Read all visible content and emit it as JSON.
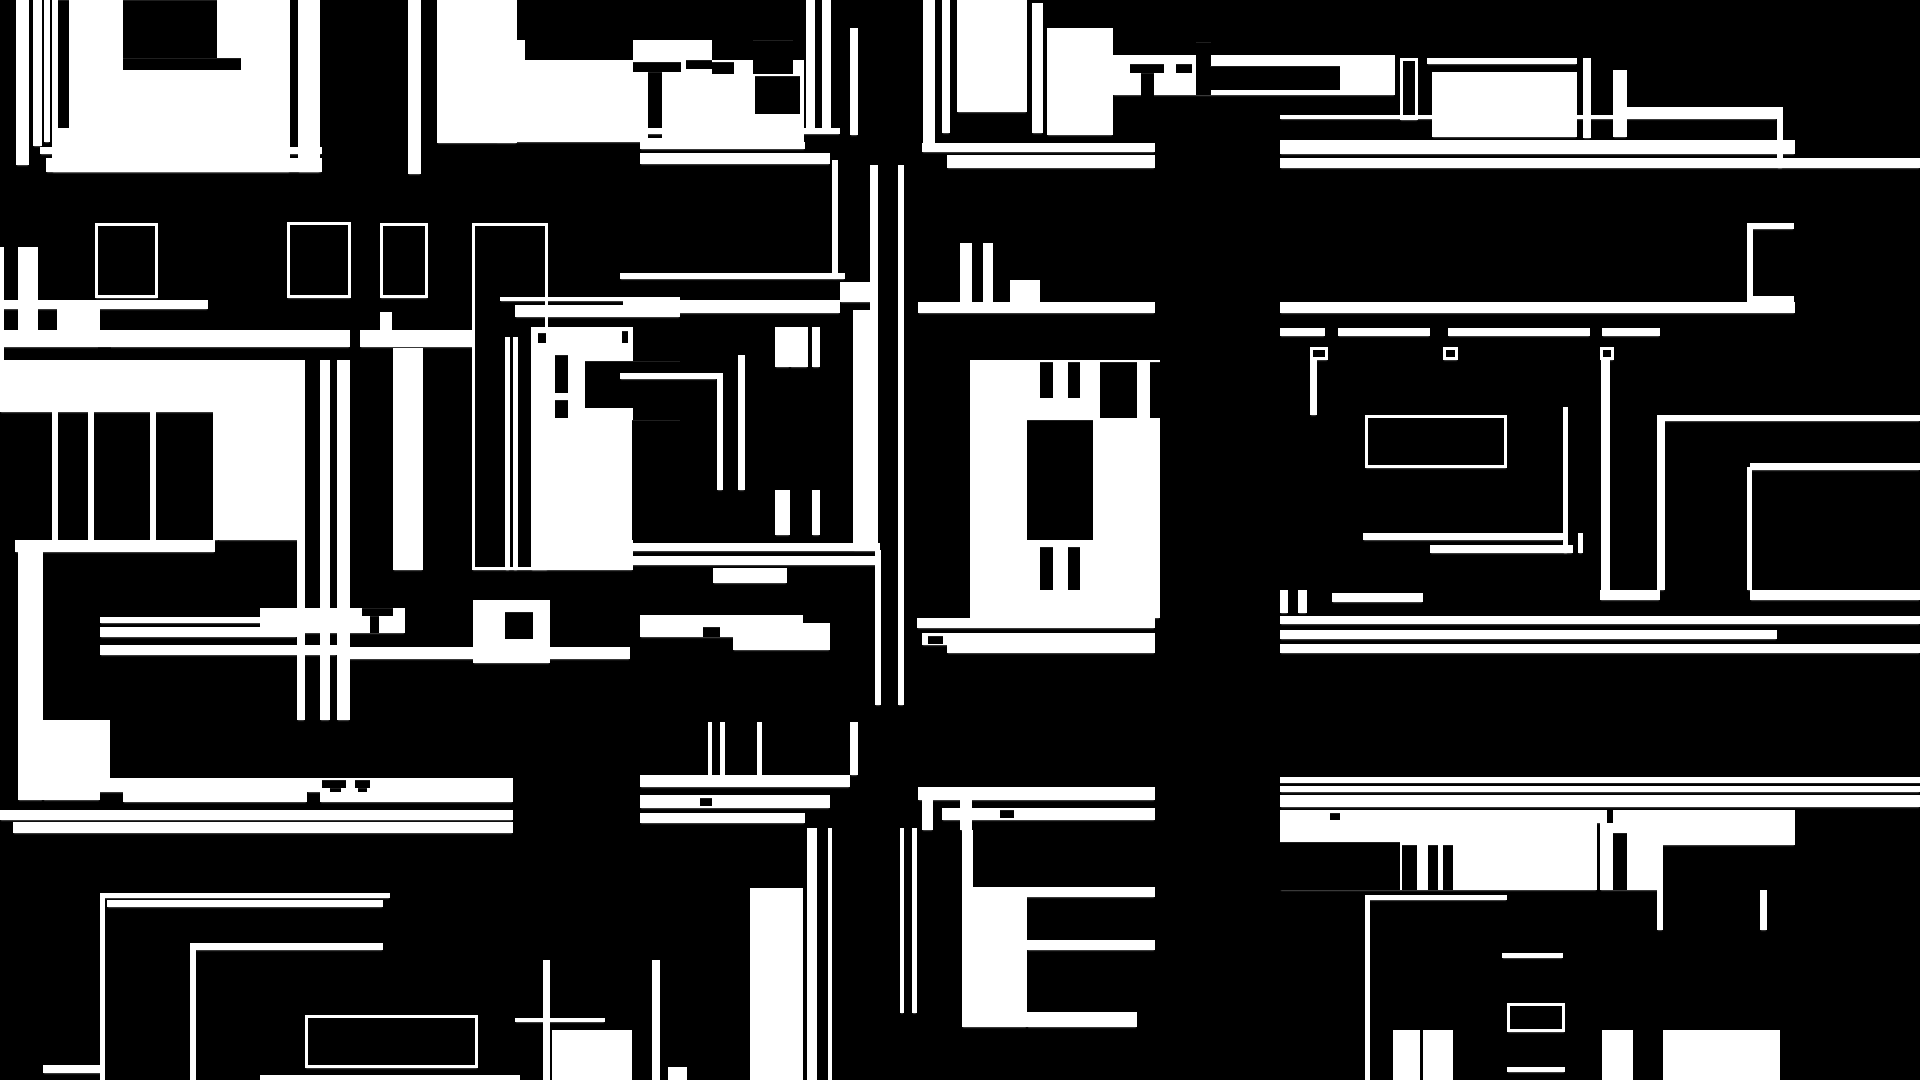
{
  "canvas": {
    "width": 1920,
    "height": 1080,
    "background_color": "#000000",
    "shape_color": "#ffffff",
    "edge_antialias_tint": "#999999",
    "kind_legend": {
      "f": "white-filled-block",
      "b": "black-cutout-block",
      "o": "white-outlined-frame"
    },
    "content_type": "abstract-glitch-mosaic",
    "visible_text": ""
  },
  "rects": [
    [
      16,
      0,
      13,
      165,
      "f"
    ],
    [
      33,
      0,
      9,
      146,
      "f"
    ],
    [
      44,
      0,
      6,
      142,
      "f"
    ],
    [
      52,
      0,
      238,
      172,
      "f"
    ],
    [
      298,
      0,
      22,
      172,
      "f"
    ],
    [
      58,
      0,
      11,
      128,
      "b"
    ],
    [
      123,
      0,
      94,
      58,
      "b"
    ],
    [
      123,
      58,
      118,
      12,
      "b"
    ],
    [
      40,
      147,
      282,
      7,
      "f"
    ],
    [
      46,
      158,
      276,
      14,
      "f"
    ],
    [
      408,
      0,
      13,
      174,
      "f"
    ],
    [
      437,
      0,
      80,
      143,
      "f"
    ],
    [
      500,
      38,
      9,
      102,
      "f"
    ],
    [
      517,
      40,
      8,
      98,
      "f"
    ],
    [
      633,
      40,
      79,
      22,
      "f"
    ],
    [
      496,
      60,
      308,
      82,
      "f"
    ],
    [
      633,
      62,
      48,
      10,
      "b"
    ],
    [
      648,
      72,
      14,
      66,
      "b"
    ],
    [
      686,
      60,
      26,
      9,
      "b"
    ],
    [
      712,
      62,
      22,
      12,
      "b"
    ],
    [
      753,
      40,
      40,
      34,
      "b"
    ],
    [
      755,
      76,
      45,
      38,
      "b"
    ],
    [
      806,
      0,
      9,
      132,
      "f"
    ],
    [
      822,
      0,
      9,
      132,
      "f"
    ],
    [
      850,
      28,
      8,
      107,
      "f"
    ],
    [
      923,
      0,
      12,
      143,
      "f"
    ],
    [
      942,
      0,
      8,
      133,
      "f"
    ],
    [
      957,
      0,
      70,
      112,
      "f"
    ],
    [
      1032,
      3,
      11,
      130,
      "f"
    ],
    [
      1047,
      28,
      66,
      107,
      "f"
    ],
    [
      1113,
      55,
      282,
      40,
      "f"
    ],
    [
      1130,
      64,
      34,
      9,
      "b"
    ],
    [
      1141,
      73,
      13,
      54,
      "b"
    ],
    [
      1176,
      64,
      16,
      9,
      "b"
    ],
    [
      1196,
      42,
      15,
      53,
      "b"
    ],
    [
      1210,
      66,
      130,
      24,
      "b"
    ],
    [
      1400,
      58,
      18,
      62,
      "o"
    ],
    [
      1427,
      58,
      150,
      6,
      "f"
    ],
    [
      1432,
      72,
      145,
      65,
      "f"
    ],
    [
      1583,
      58,
      8,
      80,
      "f"
    ],
    [
      1613,
      70,
      14,
      67,
      "f"
    ],
    [
      1627,
      107,
      150,
      9,
      "f"
    ],
    [
      1280,
      115,
      497,
      4,
      "f"
    ],
    [
      1777,
      107,
      6,
      61,
      "f"
    ],
    [
      622,
      128,
      218,
      6,
      "f"
    ],
    [
      640,
      142,
      165,
      7,
      "f"
    ],
    [
      640,
      153,
      190,
      11,
      "f"
    ],
    [
      922,
      143,
      233,
      9,
      "f"
    ],
    [
      947,
      155,
      208,
      13,
      "f"
    ],
    [
      1280,
      140,
      515,
      14,
      "f"
    ],
    [
      1280,
      158,
      640,
      10,
      "f"
    ],
    [
      832,
      160,
      6,
      118,
      "f"
    ],
    [
      853,
      310,
      25,
      240,
      "f"
    ],
    [
      870,
      165,
      8,
      148,
      "f"
    ],
    [
      898,
      165,
      6,
      540,
      "f"
    ],
    [
      875,
      550,
      6,
      155,
      "f"
    ],
    [
      620,
      273,
      225,
      6,
      "f"
    ],
    [
      840,
      282,
      38,
      20,
      "f"
    ],
    [
      623,
      300,
      217,
      13,
      "f"
    ],
    [
      0,
      300,
      208,
      9,
      "f"
    ],
    [
      918,
      302,
      237,
      11,
      "f"
    ],
    [
      1280,
      302,
      515,
      11,
      "f"
    ],
    [
      0,
      330,
      350,
      17,
      "f"
    ],
    [
      360,
      330,
      162,
      17,
      "f"
    ],
    [
      98,
      347,
      13,
      14,
      "b"
    ],
    [
      18,
      247,
      20,
      83,
      "f"
    ],
    [
      0,
      247,
      4,
      113,
      "f"
    ],
    [
      57,
      309,
      43,
      21,
      "f"
    ],
    [
      960,
      243,
      12,
      60,
      "f"
    ],
    [
      983,
      243,
      10,
      60,
      "f"
    ],
    [
      1010,
      280,
      30,
      22,
      "f"
    ],
    [
      1280,
      328,
      45,
      8,
      "f"
    ],
    [
      1338,
      328,
      92,
      8,
      "f"
    ],
    [
      1448,
      328,
      142,
      8,
      "f"
    ],
    [
      1602,
      328,
      58,
      8,
      "f"
    ],
    [
      1310,
      347,
      18,
      13,
      "o"
    ],
    [
      1443,
      347,
      15,
      13,
      "o"
    ],
    [
      1600,
      347,
      14,
      13,
      "o"
    ],
    [
      95,
      223,
      63,
      75,
      "o"
    ],
    [
      287,
      222,
      64,
      76,
      "o"
    ],
    [
      380,
      223,
      48,
      75,
      "o"
    ],
    [
      1747,
      223,
      47,
      6,
      "f"
    ],
    [
      1747,
      229,
      6,
      67,
      "f"
    ],
    [
      1747,
      296,
      47,
      6,
      "f"
    ],
    [
      472,
      223,
      76,
      347,
      "o"
    ],
    [
      505,
      337,
      5,
      233,
      "f"
    ],
    [
      513,
      337,
      5,
      233,
      "f"
    ],
    [
      380,
      312,
      12,
      31,
      "f"
    ],
    [
      393,
      348,
      30,
      222,
      "f"
    ],
    [
      500,
      297,
      180,
      4,
      "f"
    ],
    [
      515,
      305,
      165,
      12,
      "f"
    ],
    [
      531,
      327,
      102,
      243,
      "f"
    ],
    [
      538,
      333,
      8,
      10,
      "b"
    ],
    [
      622,
      331,
      6,
      12,
      "b"
    ],
    [
      555,
      355,
      13,
      38,
      "b"
    ],
    [
      555,
      400,
      13,
      18,
      "b"
    ],
    [
      585,
      361,
      95,
      47,
      "b"
    ],
    [
      632,
      420,
      48,
      120,
      "b"
    ],
    [
      0,
      360,
      300,
      52,
      "f"
    ],
    [
      52,
      412,
      6,
      128,
      "f"
    ],
    [
      88,
      412,
      6,
      128,
      "f"
    ],
    [
      150,
      412,
      6,
      128,
      "f"
    ],
    [
      213,
      412,
      6,
      128,
      "f"
    ],
    [
      218,
      412,
      82,
      128,
      "f"
    ],
    [
      297,
      360,
      8,
      360,
      "f"
    ],
    [
      15,
      540,
      200,
      12,
      "f"
    ],
    [
      18,
      552,
      25,
      168,
      "f"
    ],
    [
      320,
      360,
      10,
      360,
      "f"
    ],
    [
      337,
      360,
      13,
      360,
      "f"
    ],
    [
      717,
      373,
      6,
      117,
      "f"
    ],
    [
      620,
      373,
      97,
      6,
      "f"
    ],
    [
      738,
      355,
      7,
      135,
      "f"
    ],
    [
      775,
      327,
      15,
      40,
      "f"
    ],
    [
      790,
      327,
      18,
      40,
      "f"
    ],
    [
      812,
      327,
      8,
      40,
      "f"
    ],
    [
      775,
      490,
      15,
      45,
      "f"
    ],
    [
      812,
      490,
      8,
      45,
      "f"
    ],
    [
      620,
      543,
      260,
      8,
      "f"
    ],
    [
      620,
      556,
      260,
      9,
      "f"
    ],
    [
      713,
      568,
      74,
      15,
      "f"
    ],
    [
      970,
      360,
      190,
      258,
      "f"
    ],
    [
      1027,
      420,
      66,
      120,
      "b"
    ],
    [
      1040,
      362,
      13,
      36,
      "b"
    ],
    [
      1068,
      362,
      12,
      36,
      "b"
    ],
    [
      1040,
      547,
      13,
      43,
      "b"
    ],
    [
      1068,
      547,
      12,
      43,
      "b"
    ],
    [
      1100,
      362,
      60,
      56,
      "b"
    ],
    [
      1137,
      360,
      13,
      150,
      "f"
    ],
    [
      1310,
      360,
      7,
      55,
      "f"
    ],
    [
      1365,
      415,
      142,
      53,
      "o"
    ],
    [
      1363,
      533,
      200,
      7,
      "f"
    ],
    [
      1430,
      545,
      143,
      8,
      "f"
    ],
    [
      1563,
      407,
      5,
      146,
      "f"
    ],
    [
      1578,
      533,
      5,
      20,
      "f"
    ],
    [
      1601,
      360,
      9,
      230,
      "f"
    ],
    [
      1657,
      415,
      8,
      175,
      "f"
    ],
    [
      1658,
      415,
      262,
      6,
      "f"
    ],
    [
      1747,
      467,
      5,
      123,
      "f"
    ],
    [
      1750,
      463,
      170,
      7,
      "f"
    ],
    [
      1600,
      590,
      60,
      10,
      "f"
    ],
    [
      1750,
      590,
      170,
      10,
      "f"
    ],
    [
      1332,
      593,
      91,
      9,
      "f"
    ],
    [
      1280,
      590,
      8,
      23,
      "f"
    ],
    [
      1298,
      590,
      9,
      23,
      "f"
    ],
    [
      100,
      617,
      183,
      6,
      "f"
    ],
    [
      100,
      627,
      197,
      10,
      "f"
    ],
    [
      100,
      645,
      237,
      10,
      "f"
    ],
    [
      260,
      608,
      145,
      25,
      "f"
    ],
    [
      362,
      608,
      31,
      8,
      "b"
    ],
    [
      370,
      616,
      9,
      17,
      "b"
    ],
    [
      340,
      647,
      290,
      12,
      "f"
    ],
    [
      473,
      600,
      77,
      63,
      "f"
    ],
    [
      505,
      612,
      28,
      27,
      "b"
    ],
    [
      640,
      615,
      163,
      8,
      "f"
    ],
    [
      640,
      623,
      190,
      14,
      "f"
    ],
    [
      703,
      627,
      17,
      10,
      "b"
    ],
    [
      733,
      637,
      97,
      13,
      "f"
    ],
    [
      917,
      618,
      238,
      10,
      "f"
    ],
    [
      922,
      633,
      233,
      12,
      "f"
    ],
    [
      928,
      636,
      15,
      8,
      "b"
    ],
    [
      947,
      645,
      208,
      8,
      "f"
    ],
    [
      1280,
      616,
      640,
      8,
      "f"
    ],
    [
      1280,
      630,
      497,
      9,
      "f"
    ],
    [
      1280,
      644,
      640,
      9,
      "f"
    ],
    [
      18,
      720,
      25,
      80,
      "f"
    ],
    [
      43,
      720,
      57,
      80,
      "f"
    ],
    [
      100,
      720,
      10,
      58,
      "f"
    ],
    [
      97,
      778,
      210,
      14,
      "f"
    ],
    [
      123,
      792,
      184,
      10,
      "f"
    ],
    [
      307,
      778,
      206,
      14,
      "f"
    ],
    [
      322,
      780,
      24,
      8,
      "b"
    ],
    [
      330,
      788,
      11,
      16,
      "b"
    ],
    [
      355,
      780,
      15,
      8,
      "b"
    ],
    [
      358,
      788,
      9,
      16,
      "b"
    ],
    [
      320,
      792,
      193,
      10,
      "f"
    ],
    [
      0,
      810,
      513,
      10,
      "f"
    ],
    [
      13,
      822,
      500,
      11,
      "f"
    ],
    [
      100,
      893,
      290,
      5,
      "f"
    ],
    [
      100,
      898,
      5,
      182,
      "f"
    ],
    [
      107,
      900,
      276,
      7,
      "f"
    ],
    [
      190,
      943,
      6,
      137,
      "f"
    ],
    [
      195,
      943,
      188,
      7,
      "f"
    ],
    [
      305,
      1015,
      173,
      53,
      "o"
    ],
    [
      515,
      1018,
      90,
      4,
      "f"
    ],
    [
      543,
      960,
      7,
      120,
      "f"
    ],
    [
      552,
      1030,
      80,
      50,
      "f"
    ],
    [
      652,
      960,
      8,
      120,
      "f"
    ],
    [
      43,
      1065,
      60,
      8,
      "f"
    ],
    [
      260,
      1075,
      260,
      5,
      "f"
    ],
    [
      640,
      775,
      210,
      12,
      "f"
    ],
    [
      640,
      795,
      190,
      13,
      "f"
    ],
    [
      700,
      798,
      12,
      8,
      "b"
    ],
    [
      640,
      813,
      165,
      10,
      "f"
    ],
    [
      708,
      722,
      4,
      53,
      "f"
    ],
    [
      720,
      722,
      5,
      53,
      "f"
    ],
    [
      757,
      722,
      5,
      53,
      "f"
    ],
    [
      850,
      722,
      8,
      53,
      "f"
    ],
    [
      750,
      888,
      53,
      192,
      "f"
    ],
    [
      807,
      828,
      10,
      252,
      "f"
    ],
    [
      828,
      828,
      4,
      252,
      "f"
    ],
    [
      900,
      828,
      4,
      185,
      "f"
    ],
    [
      912,
      828,
      5,
      185,
      "f"
    ],
    [
      918,
      787,
      237,
      13,
      "f"
    ],
    [
      942,
      808,
      213,
      12,
      "f"
    ],
    [
      1000,
      810,
      14,
      8,
      "b"
    ],
    [
      922,
      800,
      11,
      30,
      "f"
    ],
    [
      960,
      800,
      12,
      30,
      "f"
    ],
    [
      962,
      830,
      11,
      57,
      "f"
    ],
    [
      962,
      887,
      65,
      140,
      "f"
    ],
    [
      987,
      887,
      168,
      10,
      "f"
    ],
    [
      1027,
      940,
      128,
      10,
      "f"
    ],
    [
      1027,
      1012,
      110,
      15,
      "f"
    ],
    [
      668,
      1067,
      19,
      13,
      "f"
    ],
    [
      757,
      1067,
      23,
      13,
      "f"
    ],
    [
      1280,
      777,
      640,
      15,
      "f"
    ],
    [
      1280,
      783,
      640,
      3,
      "b"
    ],
    [
      1280,
      795,
      640,
      12,
      "f"
    ],
    [
      1280,
      810,
      327,
      13,
      "f"
    ],
    [
      1330,
      813,
      10,
      7,
      "b"
    ],
    [
      1613,
      810,
      182,
      13,
      "f"
    ],
    [
      1280,
      823,
      317,
      67,
      "f"
    ],
    [
      1280,
      842,
      120,
      48,
      "b"
    ],
    [
      1402,
      845,
      15,
      45,
      "b"
    ],
    [
      1428,
      845,
      10,
      45,
      "b"
    ],
    [
      1443,
      845,
      10,
      45,
      "b"
    ],
    [
      1600,
      823,
      60,
      67,
      "f"
    ],
    [
      1613,
      833,
      14,
      57,
      "b"
    ],
    [
      1627,
      823,
      168,
      22,
      "f"
    ],
    [
      1657,
      845,
      6,
      85,
      "f"
    ],
    [
      1365,
      895,
      142,
      5,
      "f"
    ],
    [
      1365,
      900,
      5,
      180,
      "f"
    ],
    [
      1502,
      953,
      61,
      5,
      "f"
    ],
    [
      1507,
      1003,
      58,
      29,
      "o"
    ],
    [
      1393,
      1030,
      27,
      50,
      "f"
    ],
    [
      1423,
      1030,
      30,
      50,
      "f"
    ],
    [
      1602,
      1030,
      31,
      50,
      "f"
    ],
    [
      1663,
      1030,
      117,
      50,
      "f"
    ],
    [
      1760,
      890,
      7,
      40,
      "f"
    ],
    [
      1507,
      1067,
      58,
      5,
      "f"
    ]
  ]
}
